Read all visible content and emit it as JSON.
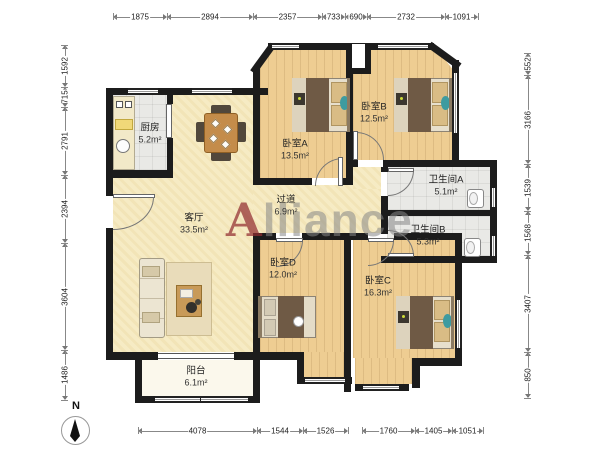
{
  "watermark": {
    "first": "A",
    "rest": "lliance"
  },
  "compass": {
    "label": "N"
  },
  "rooms": [
    {
      "id": "kitchen",
      "name": "厨房",
      "area": "5.2m²"
    },
    {
      "id": "living",
      "name": "客厅",
      "area": "33.5m²"
    },
    {
      "id": "bedroom-a",
      "name": "卧室A",
      "area": "13.5m²"
    },
    {
      "id": "bedroom-b",
      "name": "卧室B",
      "area": "12.5m²"
    },
    {
      "id": "hallway",
      "name": "过道",
      "area": "6.9m²"
    },
    {
      "id": "bath-a",
      "name": "卫生间A",
      "area": "5.1m²"
    },
    {
      "id": "bath-b",
      "name": "卫生间B",
      "area": "5.3m²"
    },
    {
      "id": "bedroom-d",
      "name": "卧室D",
      "area": "12.0m²"
    },
    {
      "id": "bedroom-c",
      "name": "卧室C",
      "area": "16.3m²"
    },
    {
      "id": "balcony",
      "name": "阳台",
      "area": "6.1m²"
    }
  ],
  "dimensions": {
    "top": [
      "1875",
      "2894",
      "2357",
      "733",
      "690",
      "2732",
      "1091"
    ],
    "bottom": [
      "4078",
      "1544",
      "1526",
      "1760",
      "1405",
      "1051"
    ],
    "left": [
      "1592",
      "715",
      "2791",
      "2394",
      "3604",
      "1486"
    ],
    "right": [
      "552",
      "3166",
      "1539",
      "1568",
      "3407",
      "850"
    ]
  },
  "colors": {
    "wall": "#1c1c1c",
    "wood_floor": "#eecd92",
    "cream_floor": "#f6ebc4",
    "tile_floor": "#e9e9e6",
    "balcony_floor": "#fbf8ec",
    "watermark_grey": "#878787",
    "watermark_red": "#912d30",
    "accent_teal": "#3e9ba0"
  }
}
